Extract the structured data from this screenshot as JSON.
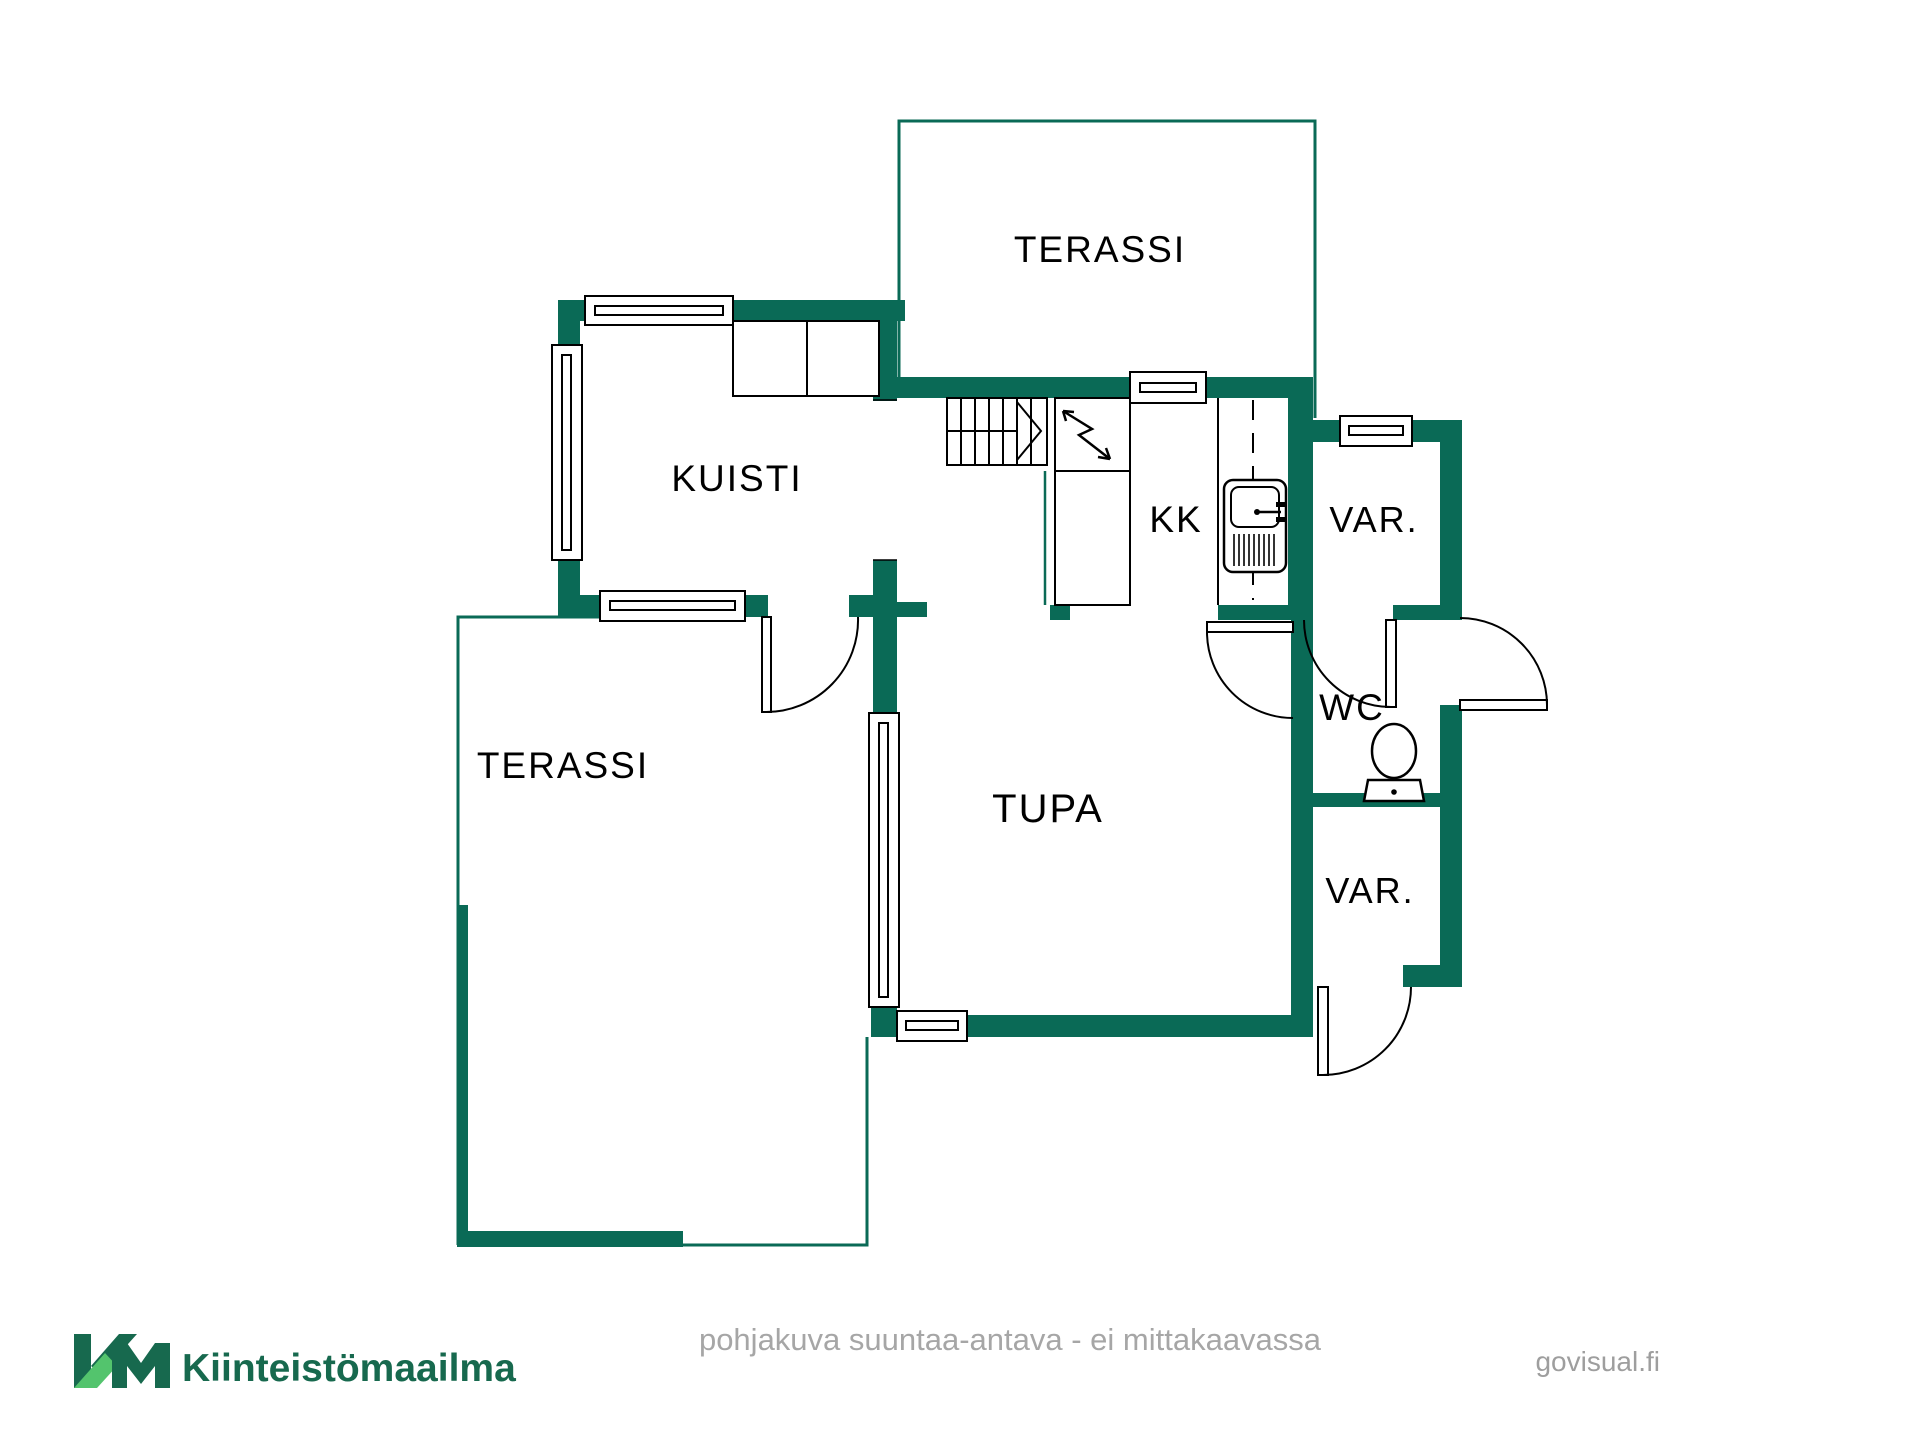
{
  "floorplan": {
    "labels": {
      "terrace_top": "TERASSI",
      "porch": "KUISTI",
      "terrace_left": "TERASSI",
      "living_room": "TUPA",
      "kitchenette": "KK",
      "storage_top": "VAR.",
      "wc": "WC",
      "storage_bottom": "VAR."
    },
    "colors": {
      "wall": "#0a6a56",
      "terrace_outline": "#0a6a56",
      "drawing_line": "#000000"
    },
    "icons": {
      "stairs": "stairs-icon",
      "electrical": "lightning-bolt-icon",
      "sink": "kitchen-sink-icon",
      "toilet": "toilet-icon",
      "window": "window-symbol",
      "door": "door-swing-symbol"
    }
  },
  "footer": {
    "logo": {
      "mark": "KM",
      "name": "Kiinteistömaailma",
      "color_dark": "#17694e",
      "color_light": "#53c46d"
    },
    "disclaimer": "pohjakuva suuntaa-antava - ei mittakaavassa",
    "credit": "govisual.fi",
    "text_color": "#a6a6a6"
  }
}
